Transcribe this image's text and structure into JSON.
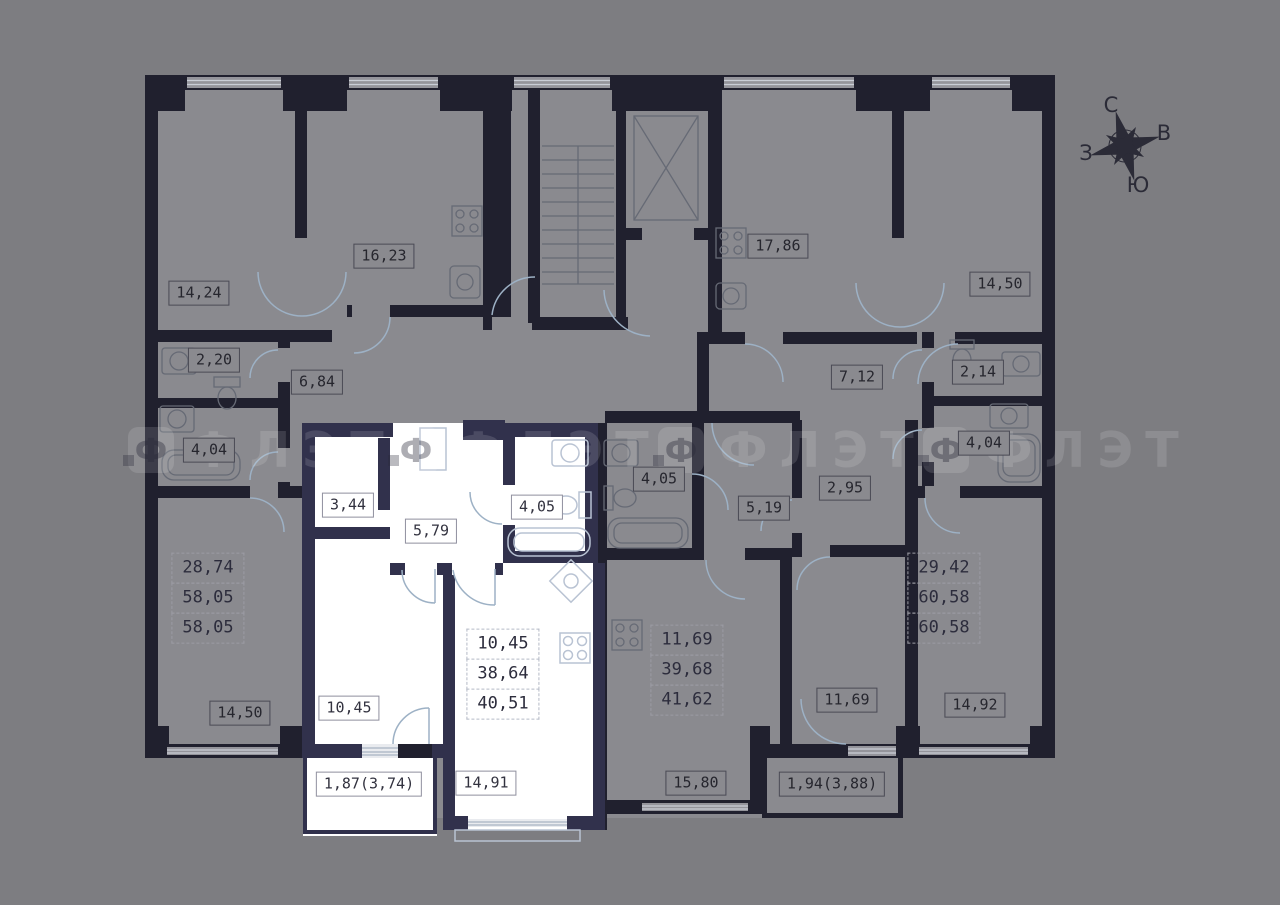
{
  "canvas": {
    "width": 1280,
    "height": 905
  },
  "palette": {
    "background": "#7d7d81",
    "room_fill": "#8a8a8f",
    "wall_dark": "#20202e",
    "wall_selected": "#31314c",
    "selected_fill": "#ffffff",
    "door_arc": "#9db1c5",
    "label_text": "#26262e"
  },
  "compass": {
    "north": "С",
    "east": "В",
    "west": "З",
    "south": "Ю"
  },
  "watermark": {
    "logo_letter": "Ф",
    "text": "ФЛЭТ",
    "positions": [
      {
        "x": 128,
        "y": 424
      },
      {
        "x": 393,
        "y": 424
      },
      {
        "x": 658,
        "y": 424
      },
      {
        "x": 923,
        "y": 424
      }
    ]
  },
  "room_labels": [
    {
      "name": "room-area-14-24",
      "text": "14,24",
      "x": 199,
      "y": 293,
      "theme": "gray"
    },
    {
      "name": "room-area-16-23",
      "text": "16,23",
      "x": 384,
      "y": 256,
      "theme": "gray"
    },
    {
      "name": "room-area-17-86",
      "text": "17,86",
      "x": 778,
      "y": 246,
      "theme": "gray"
    },
    {
      "name": "room-area-14-50-top",
      "text": "14,50",
      "x": 1000,
      "y": 284,
      "theme": "gray"
    },
    {
      "name": "room-area-2-20",
      "text": "2,20",
      "x": 214,
      "y": 360,
      "theme": "gray"
    },
    {
      "name": "room-area-6-84",
      "text": "6,84",
      "x": 317,
      "y": 382,
      "theme": "gray"
    },
    {
      "name": "room-area-7-12",
      "text": "7,12",
      "x": 857,
      "y": 377,
      "theme": "gray"
    },
    {
      "name": "room-area-2-14",
      "text": "2,14",
      "x": 978,
      "y": 372,
      "theme": "gray"
    },
    {
      "name": "room-area-4-04-left",
      "text": "4,04",
      "x": 209,
      "y": 450,
      "theme": "gray"
    },
    {
      "name": "room-area-4-04-right",
      "text": "4,04",
      "x": 984,
      "y": 443,
      "theme": "gray"
    },
    {
      "name": "room-area-3-44",
      "text": "3,44",
      "x": 348,
      "y": 505,
      "theme": "white"
    },
    {
      "name": "room-area-5-79",
      "text": "5,79",
      "x": 431,
      "y": 531,
      "theme": "white"
    },
    {
      "name": "room-area-4-05-selected",
      "text": "4,05",
      "x": 537,
      "y": 507,
      "theme": "white"
    },
    {
      "name": "room-area-4-05-middle",
      "text": "4,05",
      "x": 659,
      "y": 479,
      "theme": "gray"
    },
    {
      "name": "room-area-5-19",
      "text": "5,19",
      "x": 764,
      "y": 508,
      "theme": "gray"
    },
    {
      "name": "room-area-2-95",
      "text": "2,95",
      "x": 845,
      "y": 488,
      "theme": "gray"
    },
    {
      "name": "room-area-14-50-bottom",
      "text": "14,50",
      "x": 240,
      "y": 713,
      "theme": "gray"
    },
    {
      "name": "room-area-10-45",
      "text": "10,45",
      "x": 349,
      "y": 708,
      "theme": "white"
    },
    {
      "name": "room-area-14-91",
      "text": "14,91",
      "x": 486,
      "y": 783,
      "theme": "white"
    },
    {
      "name": "room-area-15-80",
      "text": "15,80",
      "x": 696,
      "y": 783,
      "theme": "gray"
    },
    {
      "name": "room-area-11-69",
      "text": "11,69",
      "x": 847,
      "y": 700,
      "theme": "gray"
    },
    {
      "name": "room-area-14-92",
      "text": "14,92",
      "x": 975,
      "y": 705,
      "theme": "gray"
    },
    {
      "name": "balcony-area-1-87",
      "text": "1,87(3,74)",
      "x": 369,
      "y": 784,
      "theme": "white"
    },
    {
      "name": "balcony-area-1-94",
      "text": "1,94(3,88)",
      "x": 832,
      "y": 784,
      "theme": "gray"
    }
  ],
  "apartment_summaries": [
    {
      "name": "apartment-summary-left",
      "theme": "gray",
      "x": 208,
      "y": 598,
      "values": [
        "28,74",
        "58,05",
        "58,05"
      ]
    },
    {
      "name": "apartment-summary-selected",
      "theme": "white",
      "x": 503,
      "y": 674,
      "values": [
        "10,45",
        "38,64",
        "40,51"
      ]
    },
    {
      "name": "apartment-summary-middle",
      "theme": "gray",
      "x": 687,
      "y": 670,
      "values": [
        "11,69",
        "39,68",
        "41,62"
      ]
    },
    {
      "name": "apartment-summary-right",
      "theme": "gray",
      "x": 944,
      "y": 598,
      "values": [
        "29,42",
        "60,58",
        "60,58"
      ]
    }
  ]
}
